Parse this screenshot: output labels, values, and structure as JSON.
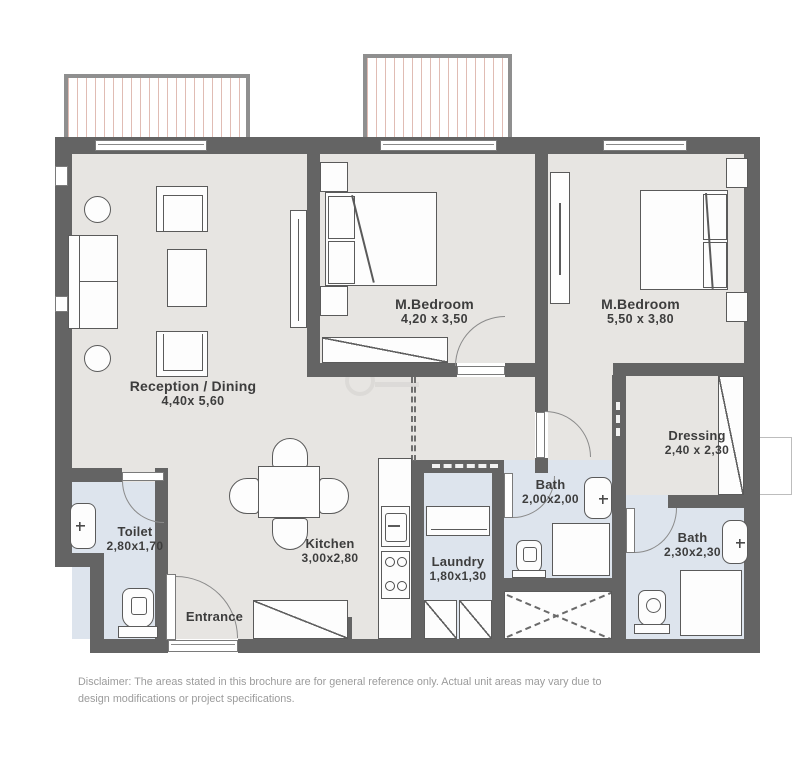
{
  "plan": {
    "rooms": {
      "reception": {
        "name": "Reception / Dining",
        "dims": "4,40x 5,60"
      },
      "bedroom_left": {
        "name": "M.Bedroom",
        "dims": "4,20 x 3,50"
      },
      "bedroom_right": {
        "name": "M.Bedroom",
        "dims": "5,50 x 3,80"
      },
      "dressing": {
        "name": "Dressing",
        "dims": "2,40 x 2,30"
      },
      "bath_middle": {
        "name": "Bath",
        "dims": "2,00x2,00"
      },
      "bath_right": {
        "name": "Bath",
        "dims": "2,30x2,30"
      },
      "toilet": {
        "name": "Toilet",
        "dims": "2,80x1,70"
      },
      "kitchen": {
        "name": "Kitchen",
        "dims": "3,00x2,80"
      },
      "laundry": {
        "name": "Laundry",
        "dims": "1,80x1,30"
      },
      "entrance": {
        "name": "Entrance"
      }
    },
    "disclaimer": "Disclaimer: The areas stated in this brochure are for general reference only. Actual unit areas may vary due to design modifications or project specifications.",
    "colors": {
      "wall": "#646464",
      "floor": "#e7e5e2",
      "wet_floor": "#dde4ed",
      "balcony_hatch": "#e0bcb4",
      "label_text": "#3d3d3d",
      "disclaimer_text": "#9b9b9b"
    }
  }
}
